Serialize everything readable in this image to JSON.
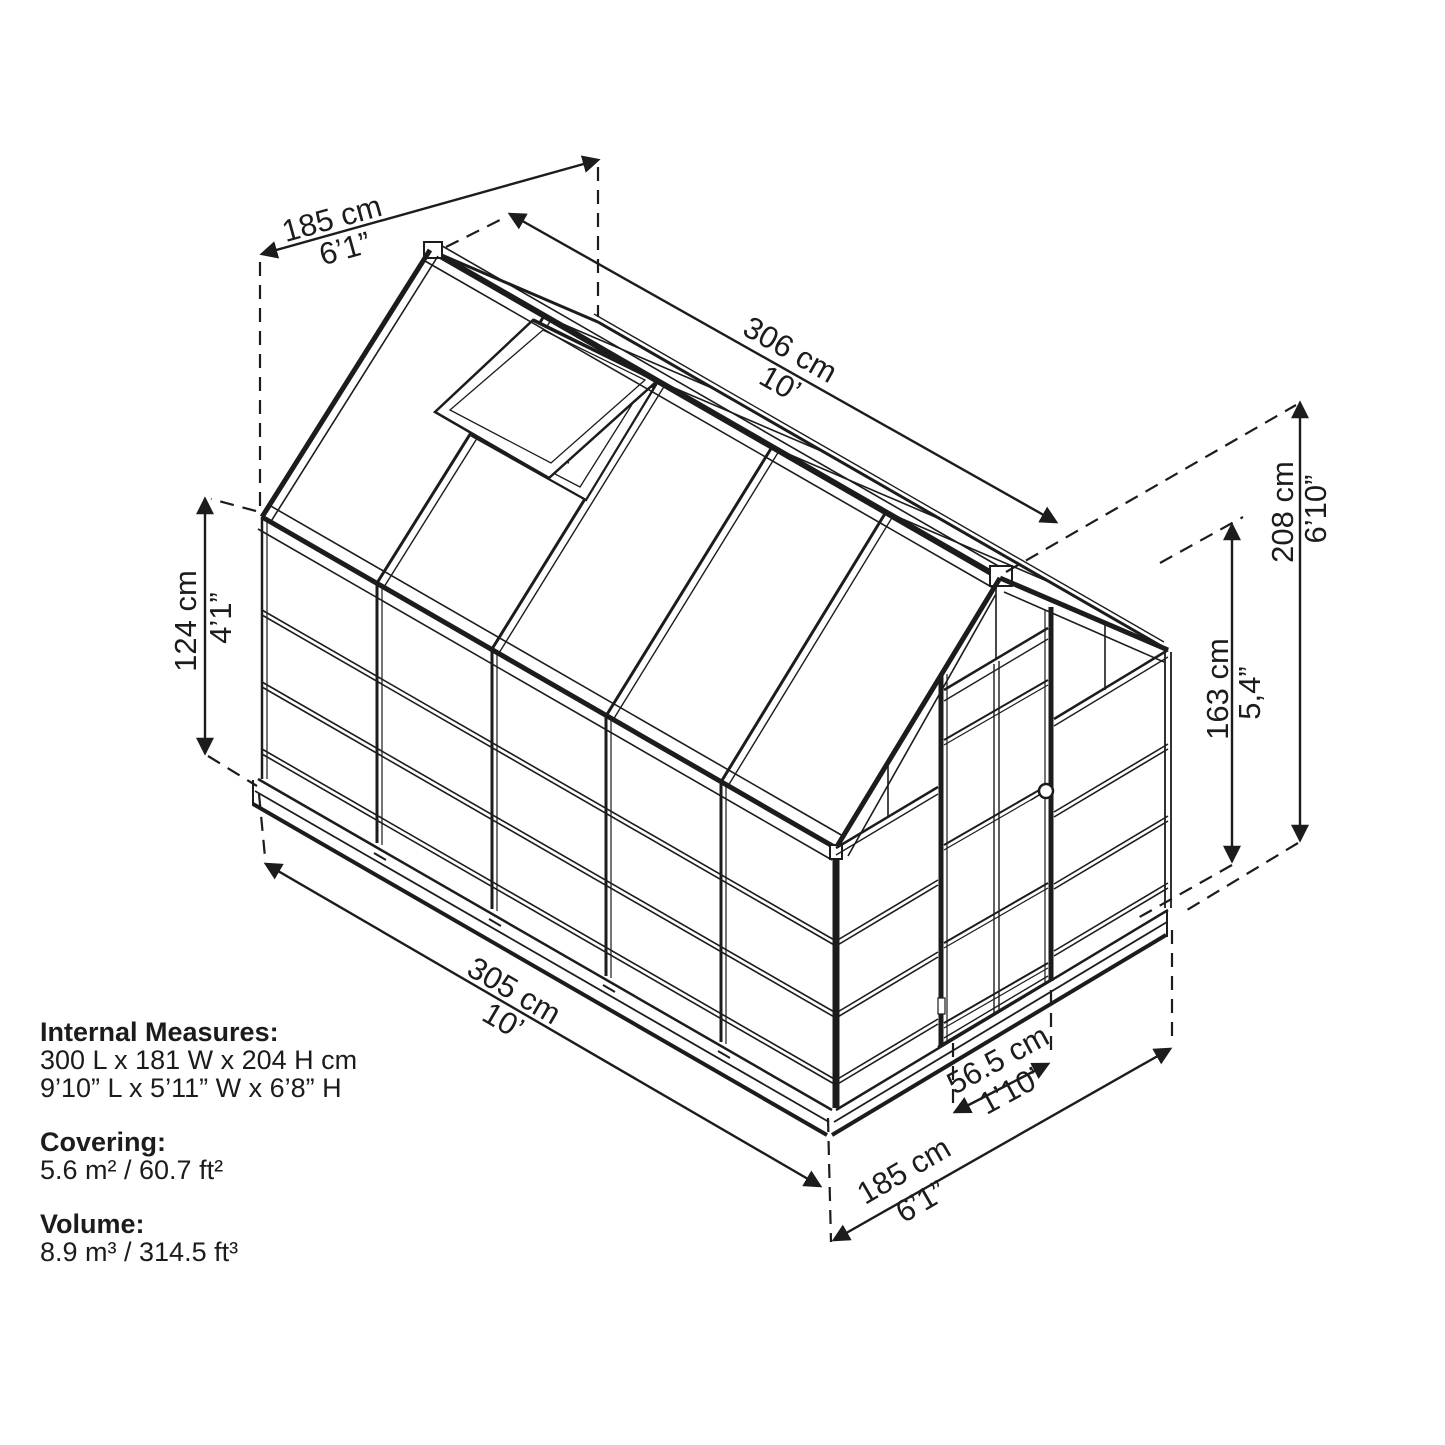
{
  "diagram": {
    "subject": "greenhouse-dimension-drawing",
    "line_color": "#1c1c1c",
    "background": "#ffffff"
  },
  "dimensions": {
    "width_top": {
      "metric": "185 cm",
      "imperial": "6’1”"
    },
    "roof_length": {
      "metric": "306 cm",
      "imperial": "10’"
    },
    "wall_panel_height": {
      "metric": "124 cm",
      "imperial": "4’1”"
    },
    "ridge_height": {
      "metric": "208 cm",
      "imperial": "6’10”"
    },
    "eave_height": {
      "metric": "163 cm",
      "imperial": "5,4”"
    },
    "base_length": {
      "metric": "305 cm",
      "imperial": "10’"
    },
    "door_width": {
      "metric": "56.5 cm",
      "imperial": "1’10”"
    },
    "base_width": {
      "metric": "185 cm",
      "imperial": "6’1”"
    }
  },
  "specs": {
    "internal": {
      "heading": "Internal Measures:",
      "metric": "300 L x 181 W x 204 H cm",
      "imperial": "9’10” L x 5’11” W x 6’8” H"
    },
    "covering": {
      "heading": "Covering:",
      "value": "5.6 m² / 60.7 ft²"
    },
    "volume": {
      "heading": "Volume:",
      "value": "8.9 m³ / 314.5 ft³"
    }
  }
}
